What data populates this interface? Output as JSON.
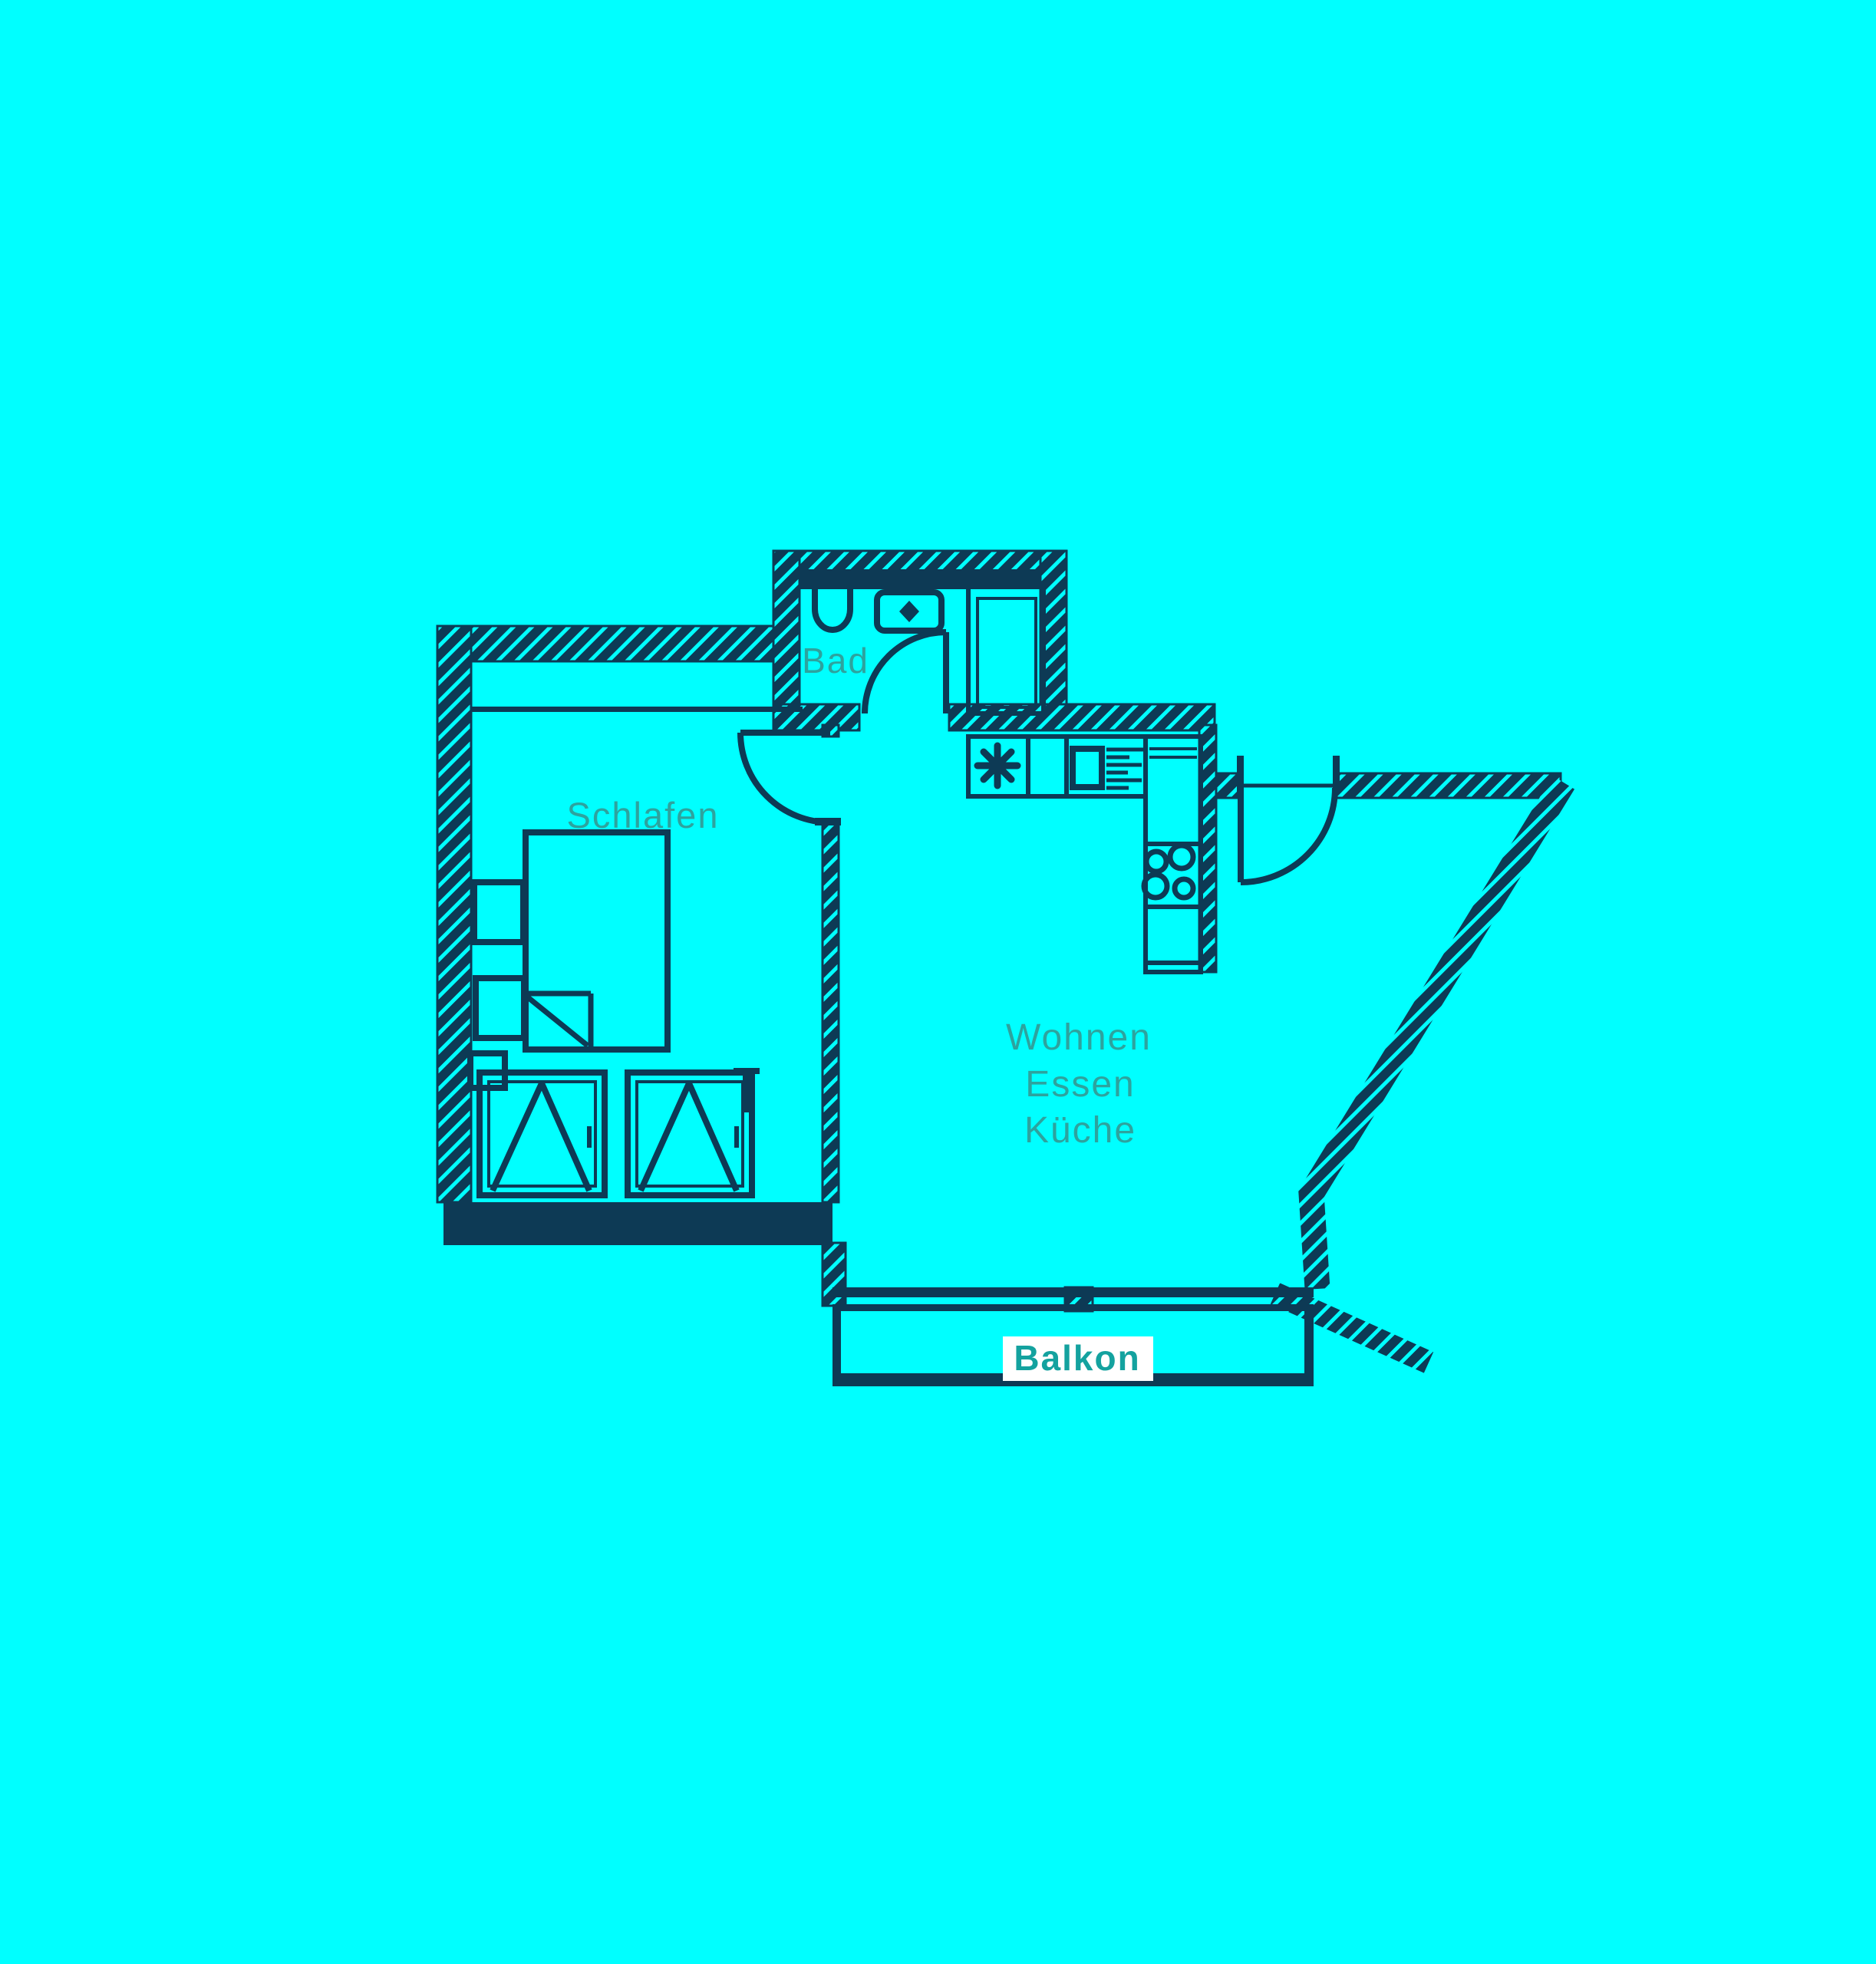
{
  "colors": {
    "background": "#00ffff",
    "ink": "#0d3a55",
    "label": "#2da39e",
    "balkon_label": "#14a29f",
    "balkon_label_bg": "#ffffff"
  },
  "labels": {
    "bathroom": "Bad",
    "bedroom": "Schlafen",
    "living_line1": "Wohnen",
    "living_line2": "Essen",
    "living_line3": "Küche",
    "balcony": "Balkon"
  }
}
